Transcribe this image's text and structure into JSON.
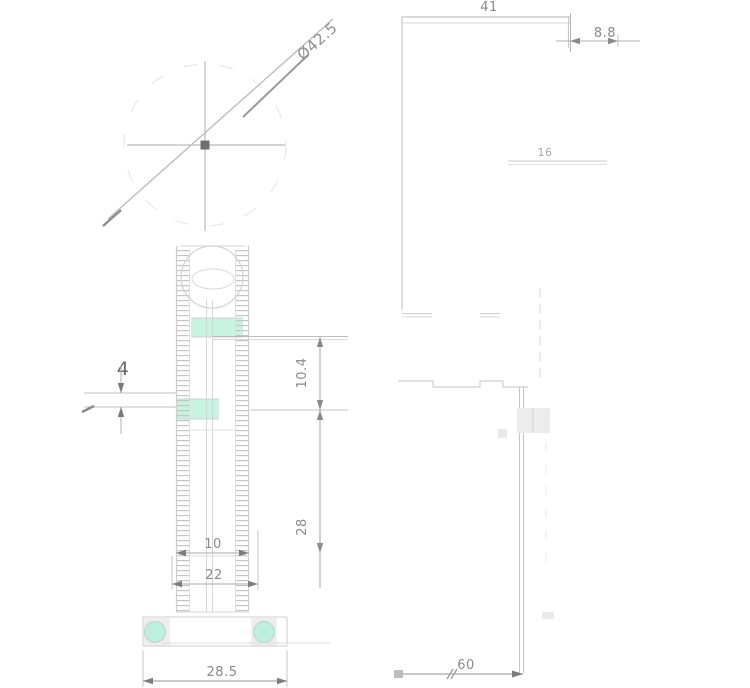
{
  "drawing": {
    "type": "technical-drawing",
    "views": {
      "front_view": "front view with roller and ribbed body",
      "side_view": "side profile view"
    }
  },
  "dimensions": {
    "roller_diameter": "Ø42.5",
    "top_width": "41",
    "top_offset": "8.8",
    "side_hole": "16",
    "plunger_travel": "4",
    "upper_height": "10.4",
    "body_height": "28",
    "lower_width_inner": "10",
    "lower_width": "22",
    "base_width": "28.5",
    "side_width": "60"
  },
  "colors": {
    "background": "#ffffff",
    "part_line": "#cfcfcf",
    "dimension_line": "#b0b0b0",
    "text": "#8a8a8a",
    "dark_accent": "#6e6e6e",
    "mint_highlight": "#c7f3e2",
    "hole_fill": "#baf0dd"
  }
}
